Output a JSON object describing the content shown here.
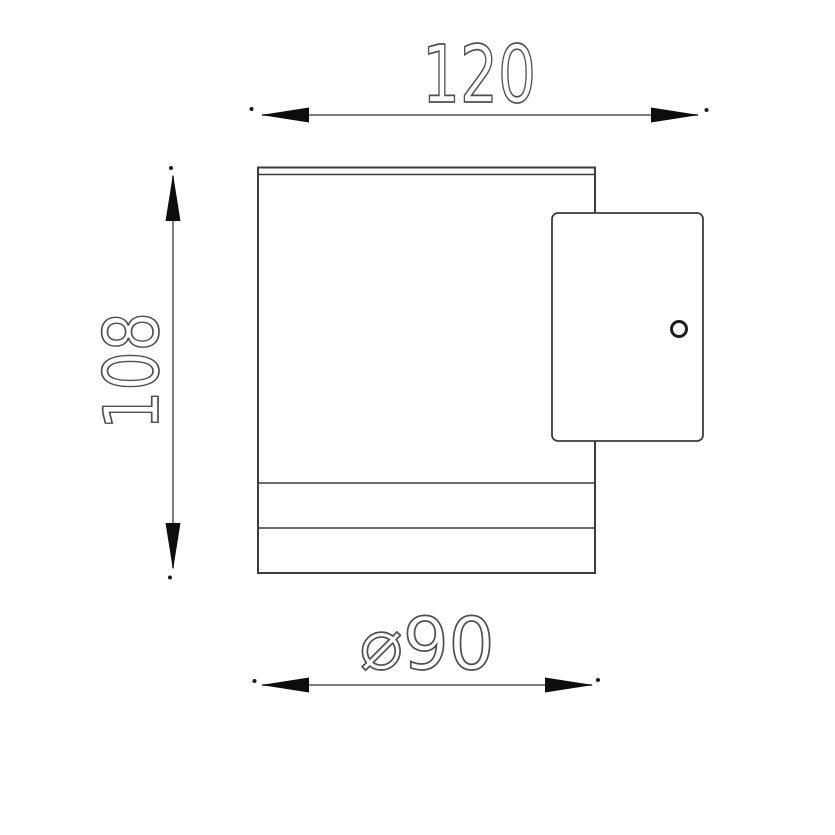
{
  "drawing": {
    "type": "technical-dimension-drawing",
    "subject": "wall-light-side-view",
    "dimensions": {
      "width": {
        "label": "120",
        "position": "top",
        "orientation": "horizontal"
      },
      "height": {
        "label": "108",
        "position": "left",
        "orientation": "vertical"
      },
      "diameter": {
        "label": "⌀90",
        "position": "bottom",
        "orientation": "horizontal"
      }
    },
    "colors": {
      "background": "#ffffff",
      "outline": "#3c3c3c",
      "dimension_line": "#7d7d7d",
      "arrowhead": "#0d0d0d",
      "label_stroke": "#4f4f4f"
    }
  }
}
